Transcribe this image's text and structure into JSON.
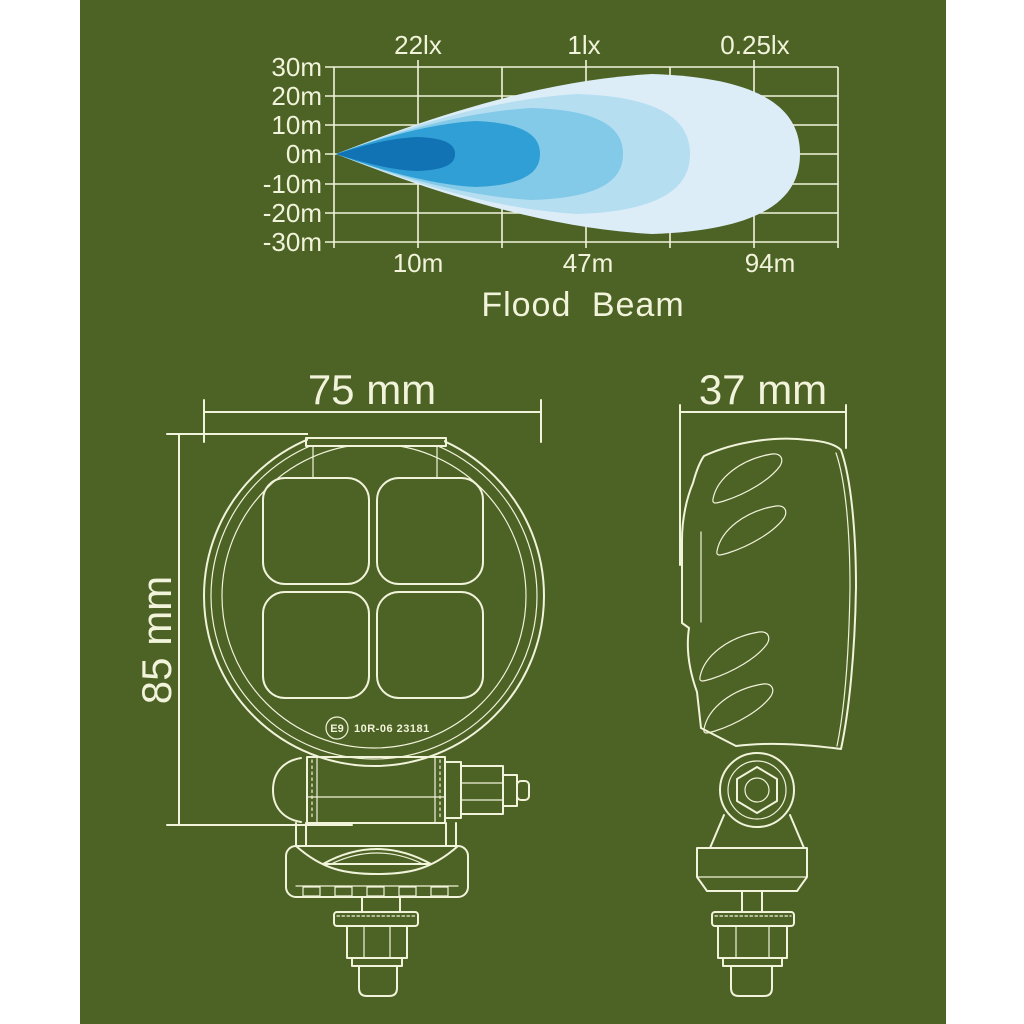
{
  "page": {
    "background": "#ffffff",
    "canvas_color": "#4d6225",
    "line_color": "#f1f3da"
  },
  "chart_data": {
    "type": "area",
    "title": "Flood Beam",
    "description": "Beam pattern iso-lux footprint of a flood work lamp",
    "x_axis": {
      "tick_labels": [
        "10m",
        "47m",
        "94m"
      ],
      "tick_values_m": [
        10,
        47,
        94
      ]
    },
    "y_axis": {
      "tick_labels": [
        "30m",
        "20m",
        "10m",
        "0m",
        "-10m",
        "-20m",
        "-30m"
      ],
      "tick_values_m": [
        30,
        20,
        10,
        0,
        -10,
        -20,
        -30
      ]
    },
    "lux_labels": [
      "22lx",
      "1lx",
      "0.25lx"
    ],
    "grid": true,
    "legend": false,
    "series": [
      {
        "name": "ring-innermost",
        "lux_label": "22lx",
        "color": "#1173b4",
        "reach_m": 18,
        "half_width_m": 6
      },
      {
        "name": "ring-2",
        "lux_label": "",
        "color": "#2f9fd6",
        "reach_m": 37,
        "half_width_m": 11
      },
      {
        "name": "ring-3",
        "lux_label": "1lx",
        "color": "#83c9e8",
        "reach_m": 57,
        "half_width_m": 16
      },
      {
        "name": "ring-4",
        "lux_label": "",
        "color": "#b5def1",
        "reach_m": 76,
        "half_width_m": 21
      },
      {
        "name": "ring-outermost",
        "lux_label": "0.25lx",
        "color": "#dcedf8",
        "reach_m": 105,
        "half_width_m": 28
      }
    ]
  },
  "front_view": {
    "width_label": "75 mm",
    "height_label": "85 mm",
    "cert_circle": "E9",
    "cert_code": "10R-06 23181"
  },
  "side_view": {
    "width_label": "37 mm"
  }
}
